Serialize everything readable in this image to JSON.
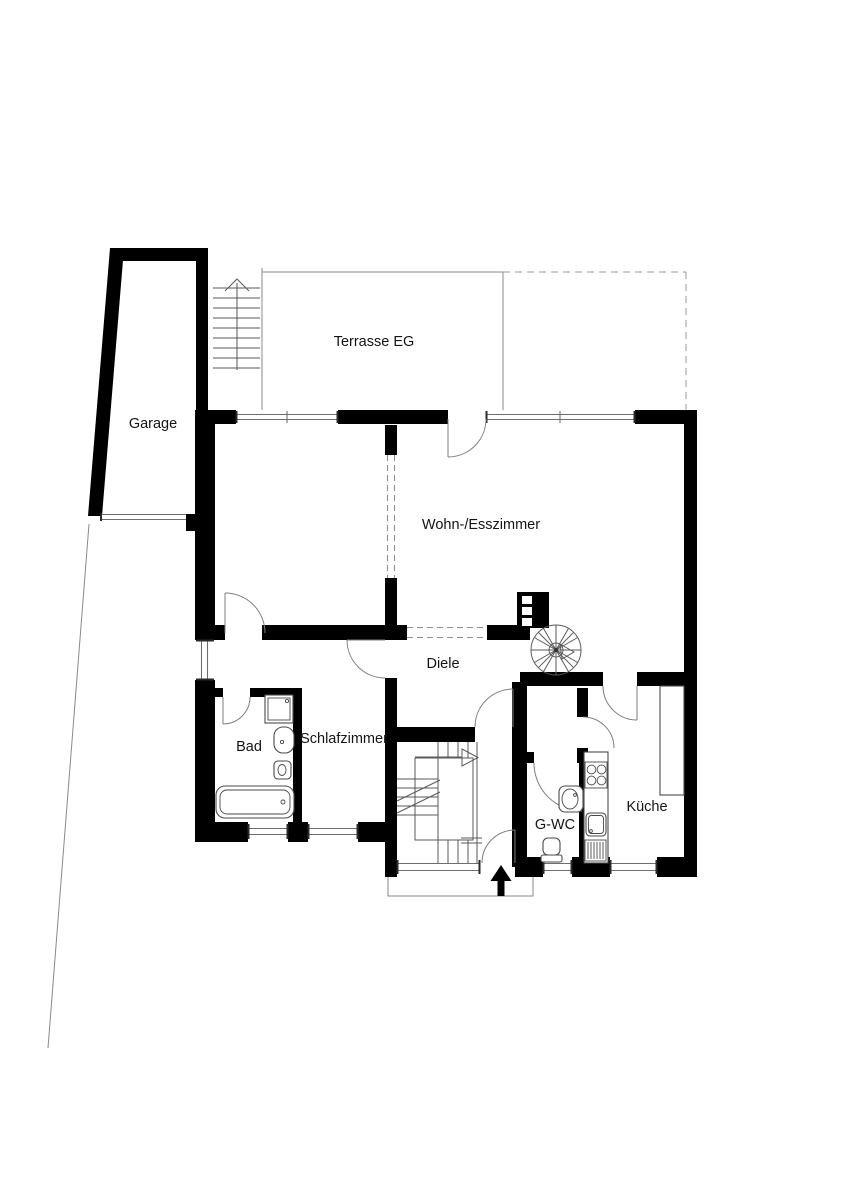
{
  "plan": {
    "type": "floor-plan",
    "floor": "EG",
    "labels": {
      "garage": "Garage",
      "terrace": "Terrasse EG",
      "living_dining": "Wohn-/Esszimmer",
      "hall": "Diele",
      "bathroom": "Bad",
      "bedroom": "Schlafzimmer",
      "guest_wc": "G-WC",
      "kitchen": "Küche"
    },
    "colors": {
      "walls": "#000000",
      "thin_lines": "#8a8a8a",
      "background": "#ffffff",
      "label_text": "#141414"
    }
  }
}
